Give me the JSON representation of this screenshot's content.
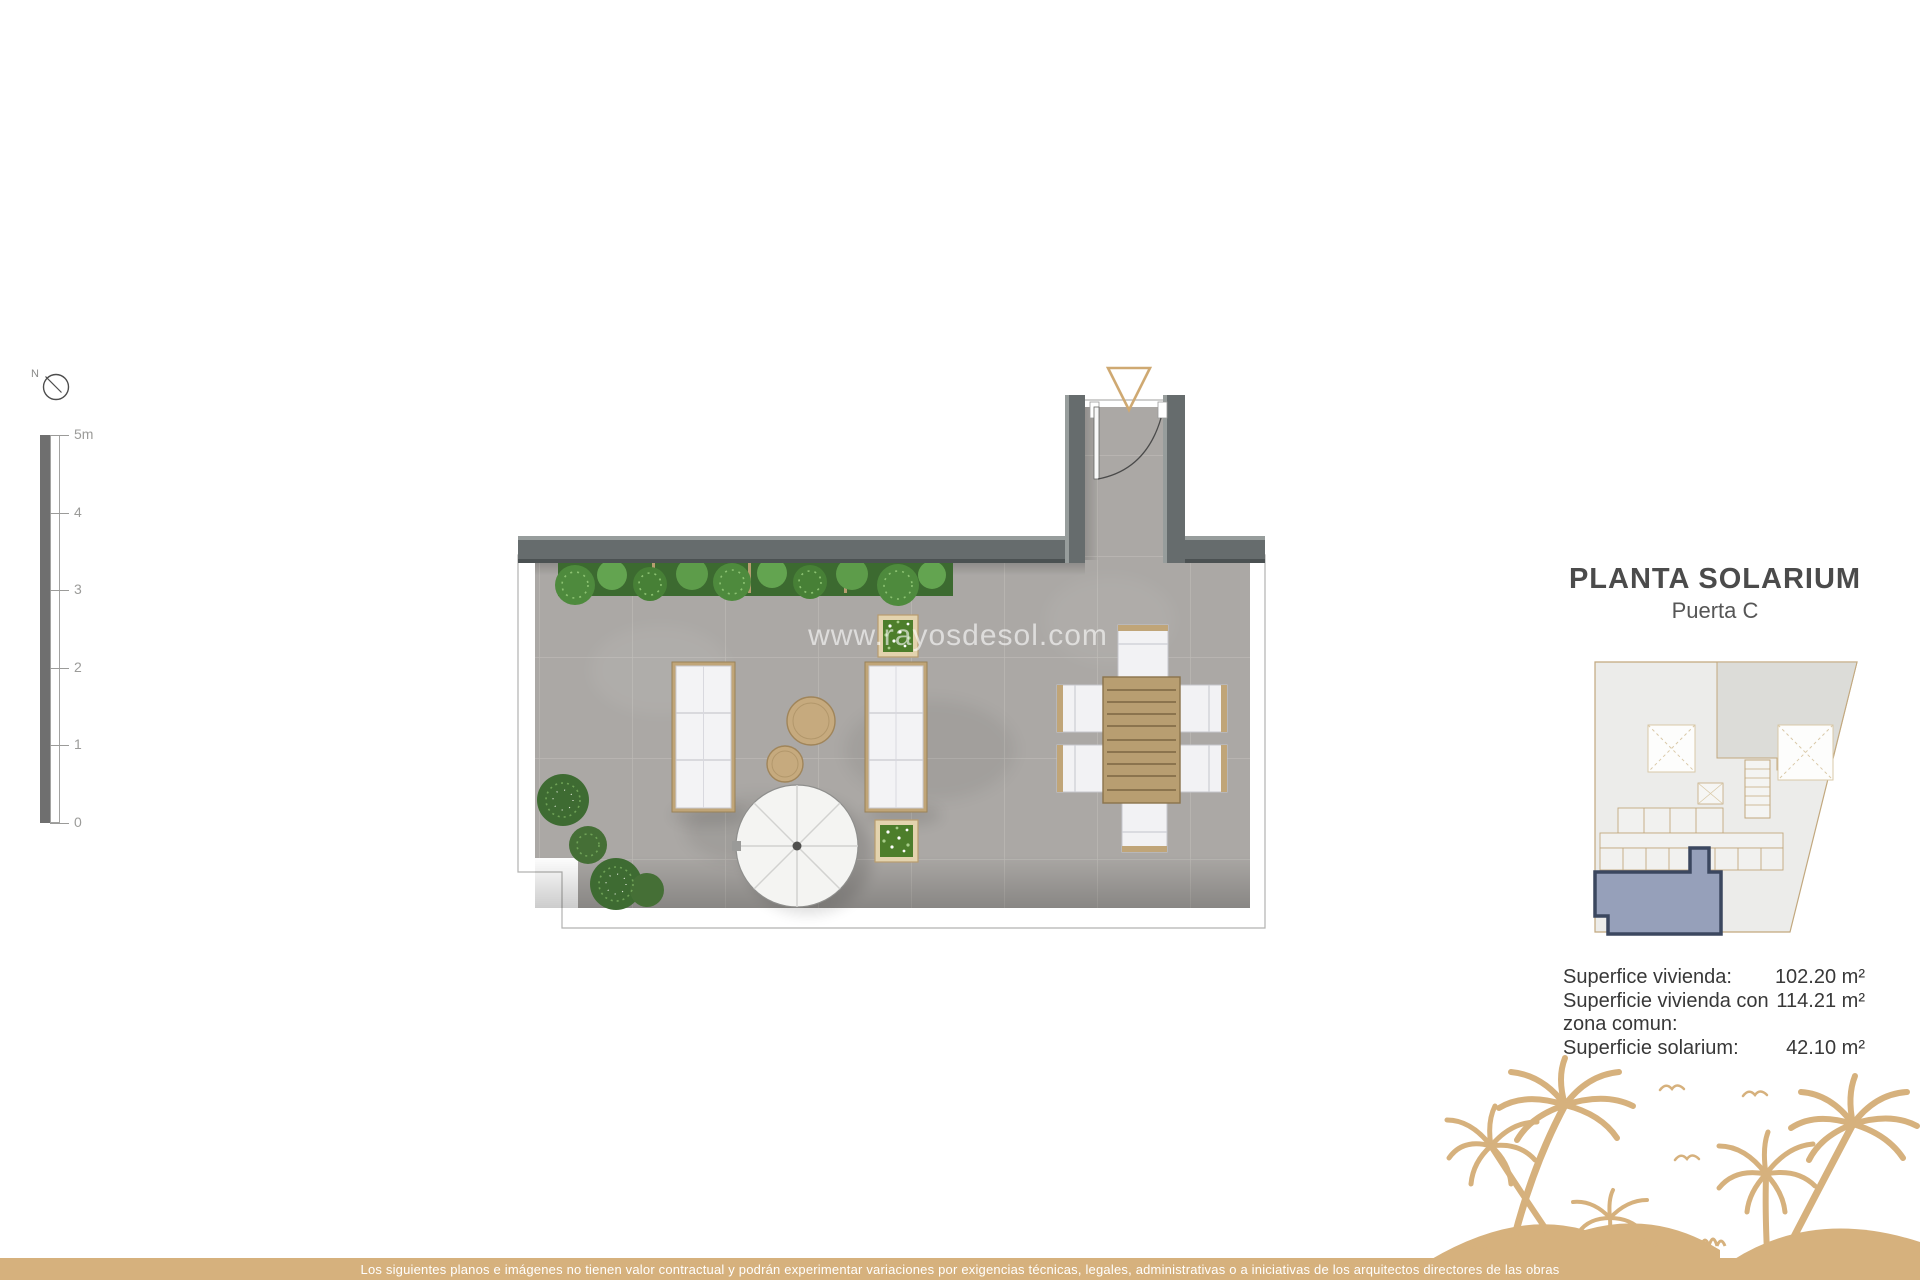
{
  "north": {
    "label": "N"
  },
  "scale_bar": {
    "labels": [
      "5m",
      "4",
      "3",
      "2",
      "1",
      "0"
    ]
  },
  "plan": {
    "watermark": "www.rayosdesol.com",
    "features": [
      "entrance-door",
      "hedge",
      "sofas",
      "coffee-tables",
      "parasol",
      "planters",
      "dining-table",
      "bushes"
    ]
  },
  "panel": {
    "title": "PLANTA SOLARIUM",
    "subtitle": "Puerta C",
    "areas": [
      {
        "label": "Superfice vivienda:",
        "value": "102.20 m²"
      },
      {
        "label": "Superficie vivienda con zona comun:",
        "value": "114.21 m²"
      },
      {
        "label": "Superficie solarium:",
        "value": "42.10 m²"
      }
    ]
  },
  "footer": {
    "disclaimer": "Los siguientes planos e imágenes no tienen valor contractual y podrán experimentar variaciones por exigencias técnicas, legales, administrativas o a iniciativas de los arquitectos directores de las obras"
  },
  "colors": {
    "accent_tan": "#d6b17d",
    "wall_gray": "#666c6d",
    "floor_gray": "#aba8a5",
    "plant_green": "#579a47",
    "unit_highlight": "#96a0ba",
    "unit_outline": "#3b475f",
    "title_gray": "#4b4b4b"
  }
}
